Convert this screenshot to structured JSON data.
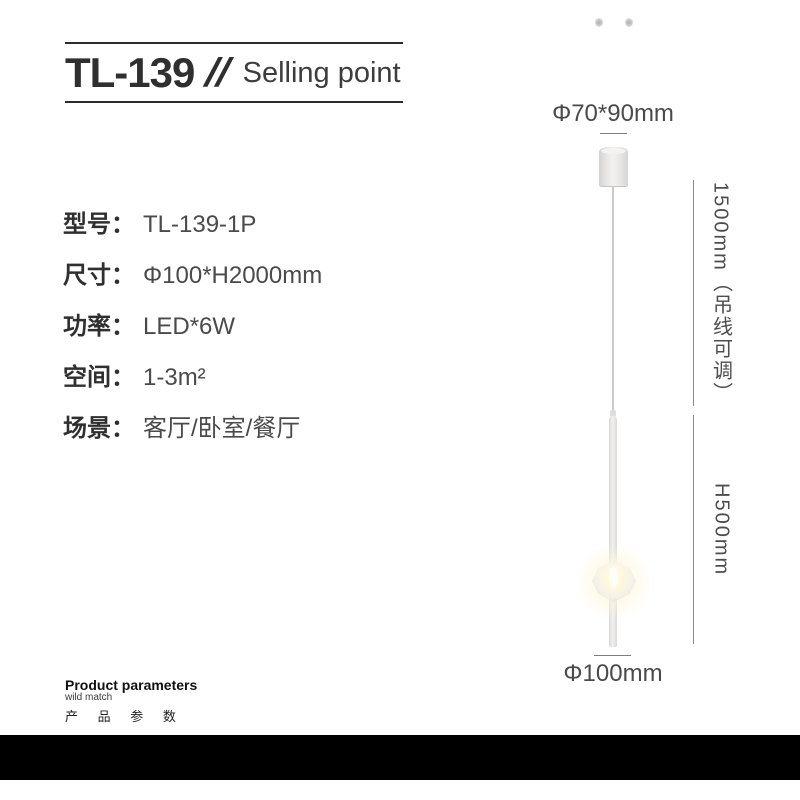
{
  "header": {
    "model": "TL-139",
    "slashes": "//",
    "subtitle": "Selling point"
  },
  "specs": [
    {
      "label": "型号：",
      "value": "TL-139-1P"
    },
    {
      "label": "尺寸：",
      "value": "Φ100*H2000mm"
    },
    {
      "label": "功率：",
      "value": "LED*6W"
    },
    {
      "label": "空间：",
      "value": "1-3m²"
    },
    {
      "label": "场景：",
      "value": "客厅/卧室/餐厅"
    }
  ],
  "diagram": {
    "top_dimension": "Φ70*90mm",
    "wire_dimension": "1500mm（吊线可调）",
    "rod_dimension": "H500mm",
    "bottom_dimension": "Φ100mm"
  },
  "footer": {
    "title": "Product parameters",
    "subtitle": "wild match",
    "caption_cn": "产 品 参 数"
  },
  "colors": {
    "background": "#ffffff",
    "text_dark": "#2f2f2f",
    "text_light": "#4a4a4a",
    "dimension_line": "#8c8c8c",
    "black_bar": "#000000",
    "lamp_body": "#e9e8e6",
    "glow_warm": "#ffeebe"
  }
}
